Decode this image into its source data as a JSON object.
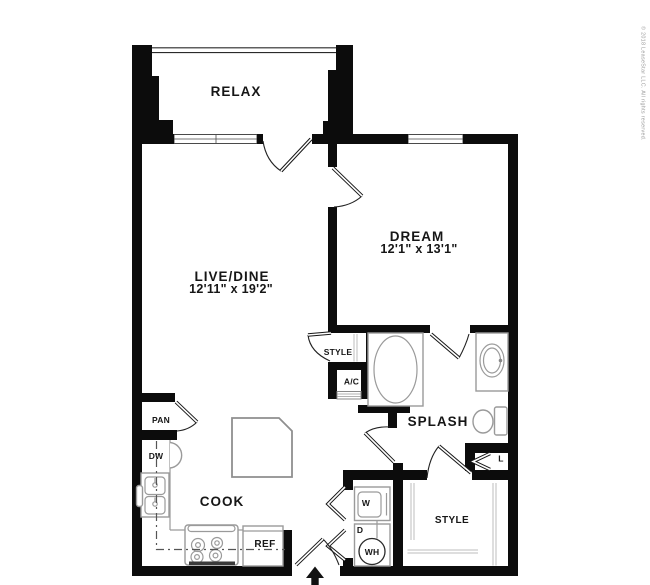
{
  "colors": {
    "background": "#ffffff",
    "wall": "#0c0c0c",
    "fixture_line": "#9a9a9a",
    "label_text": "#161616",
    "copyright_text": "#9b9b9b"
  },
  "rooms": {
    "balcony": {
      "label": "RELAX"
    },
    "living_dining": {
      "label": "LIVE/DINE",
      "dimensions": "12'11\" x 19'2\""
    },
    "bedroom": {
      "label": "DREAM",
      "dimensions": "12'1\" x 13'1\""
    },
    "bathroom": {
      "label": "SPLASH"
    },
    "kitchen": {
      "label": "COOK"
    },
    "pantry": {
      "label": "PAN"
    },
    "bedroom_closet": {
      "label": "STYLE"
    },
    "walkin_closet": {
      "label": "STYLE"
    },
    "linen_closet": {
      "label": "L"
    },
    "hvac_closet": {
      "label": "A/C"
    }
  },
  "appliances": {
    "dishwasher": {
      "label": "DW"
    },
    "refrigerator": {
      "label": "REF"
    },
    "washer": {
      "label": "W"
    },
    "dryer": {
      "label": "D"
    },
    "water_heater": {
      "label": "WH"
    }
  },
  "footer": {
    "copyright": "© 2018 LeaseStar LLC. All rights reserved."
  }
}
